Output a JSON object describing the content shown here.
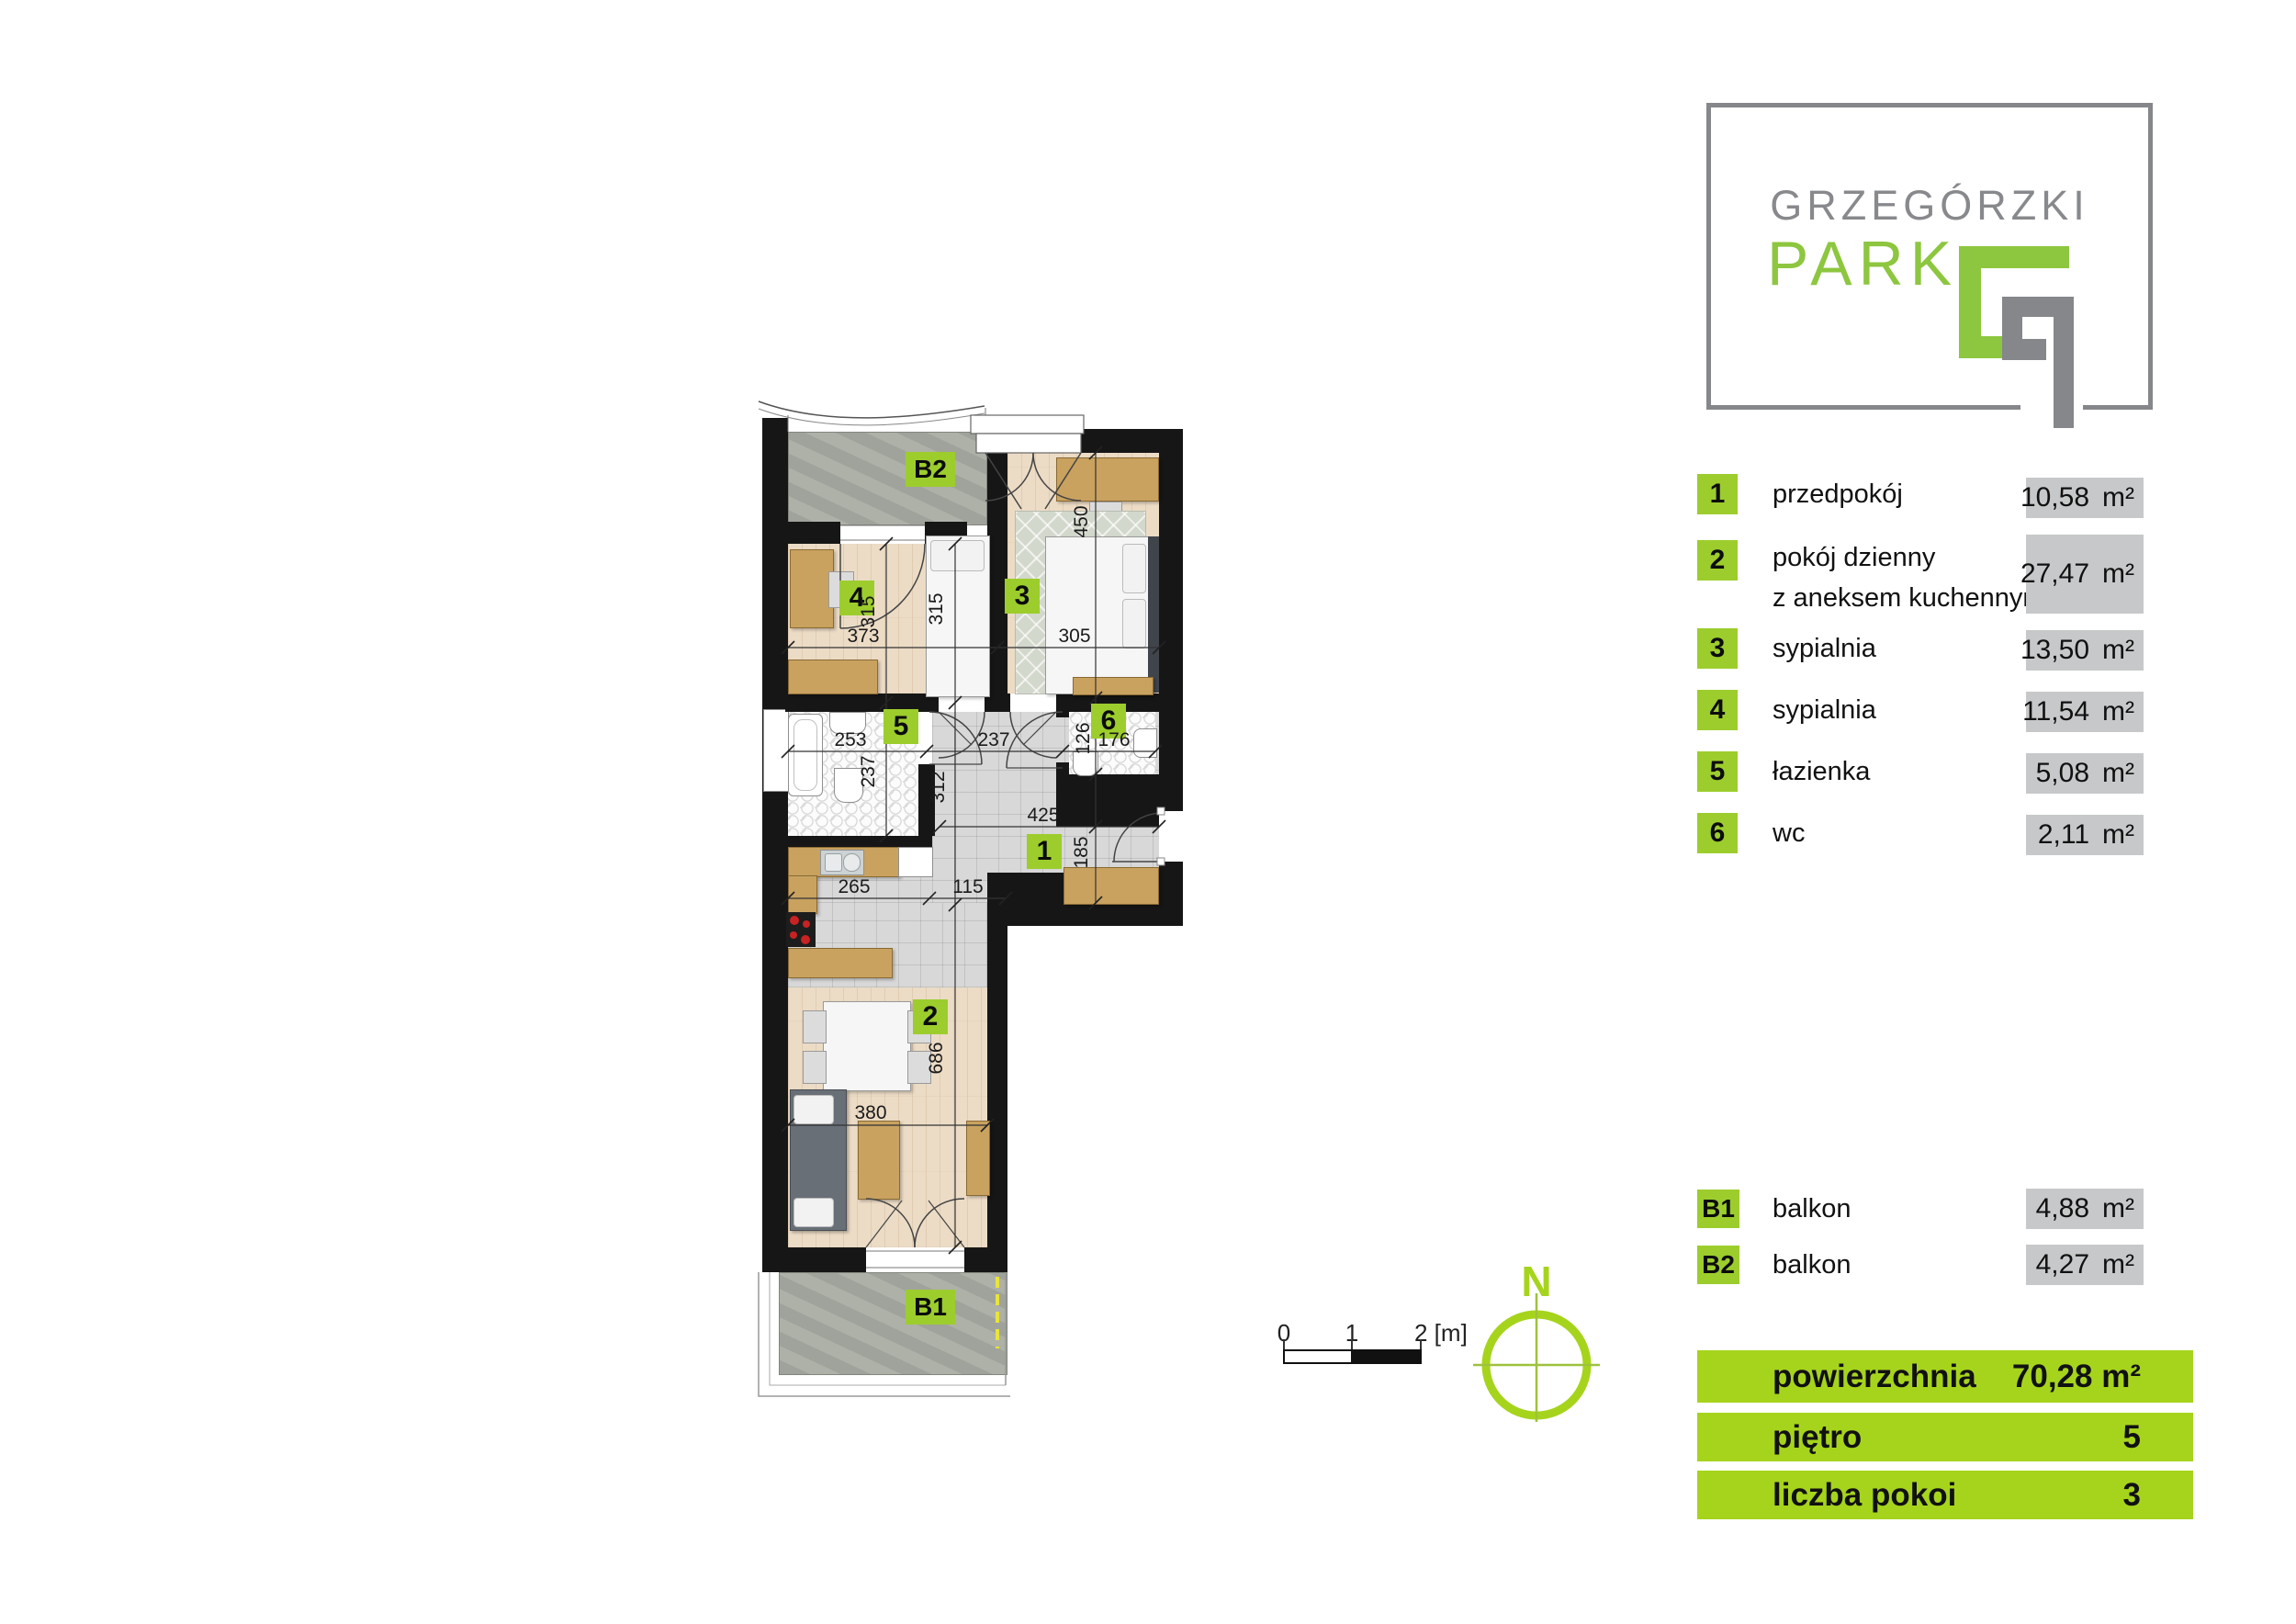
{
  "colors": {
    "accent_green": "#9ccd2d",
    "bar_green": "#a6d41c",
    "logo_green": "#8dc63f",
    "logo_gray": "#87898c",
    "value_box_gray": "#c7c8c9",
    "wall_black": "#161616"
  },
  "logo": {
    "title_line1": "GRZEGÓRZKI",
    "title_line2": "PARK"
  },
  "legend": {
    "rows": [
      {
        "id": "1",
        "label": "przedpokój",
        "area": "10,58",
        "unit": "m²"
      },
      {
        "id": "2",
        "label": "pokój dzienny",
        "label2": "z aneksem kuchennym",
        "area": "27,47",
        "unit": "m²"
      },
      {
        "id": "3",
        "label": "sypialnia",
        "area": "13,50",
        "unit": "m²"
      },
      {
        "id": "4",
        "label": "sypialnia",
        "area": "11,54",
        "unit": "m²"
      },
      {
        "id": "5",
        "label": "łazienka",
        "area": "5,08",
        "unit": "m²"
      },
      {
        "id": "6",
        "label": "wc",
        "area": "2,11",
        "unit": "m²"
      }
    ],
    "balcony_rows": [
      {
        "id": "B1",
        "label": "balkon",
        "area": "4,88",
        "unit": "m²"
      },
      {
        "id": "B2",
        "label": "balkon",
        "area": "4,27",
        "unit": "m²"
      }
    ]
  },
  "summary": {
    "rows": [
      {
        "label": "powierzchnia",
        "value": "70,28 m²"
      },
      {
        "label": "piętro",
        "value": "5"
      },
      {
        "label": "liczba pokoi",
        "value": "3"
      }
    ]
  },
  "scale_bar": {
    "tick0": "0",
    "tick1": "1",
    "tick2": "2 [m]"
  },
  "compass": {
    "north_label": "N"
  },
  "plan": {
    "room_labels": {
      "b2": "B2",
      "r4": "4",
      "r3": "3",
      "r5": "5",
      "r6": "6",
      "r1": "1",
      "r2": "2",
      "b1": "B1"
    },
    "dims": {
      "d373": "373",
      "d315a": "315",
      "d315b": "315",
      "d450": "450",
      "d305": "305",
      "d253": "253",
      "d237h": "237",
      "d176": "176",
      "d126": "126",
      "d237v": "237",
      "d312": "312",
      "d425": "425",
      "d185": "185",
      "d265": "265",
      "d115": "115",
      "d686": "686",
      "d380": "380"
    }
  }
}
